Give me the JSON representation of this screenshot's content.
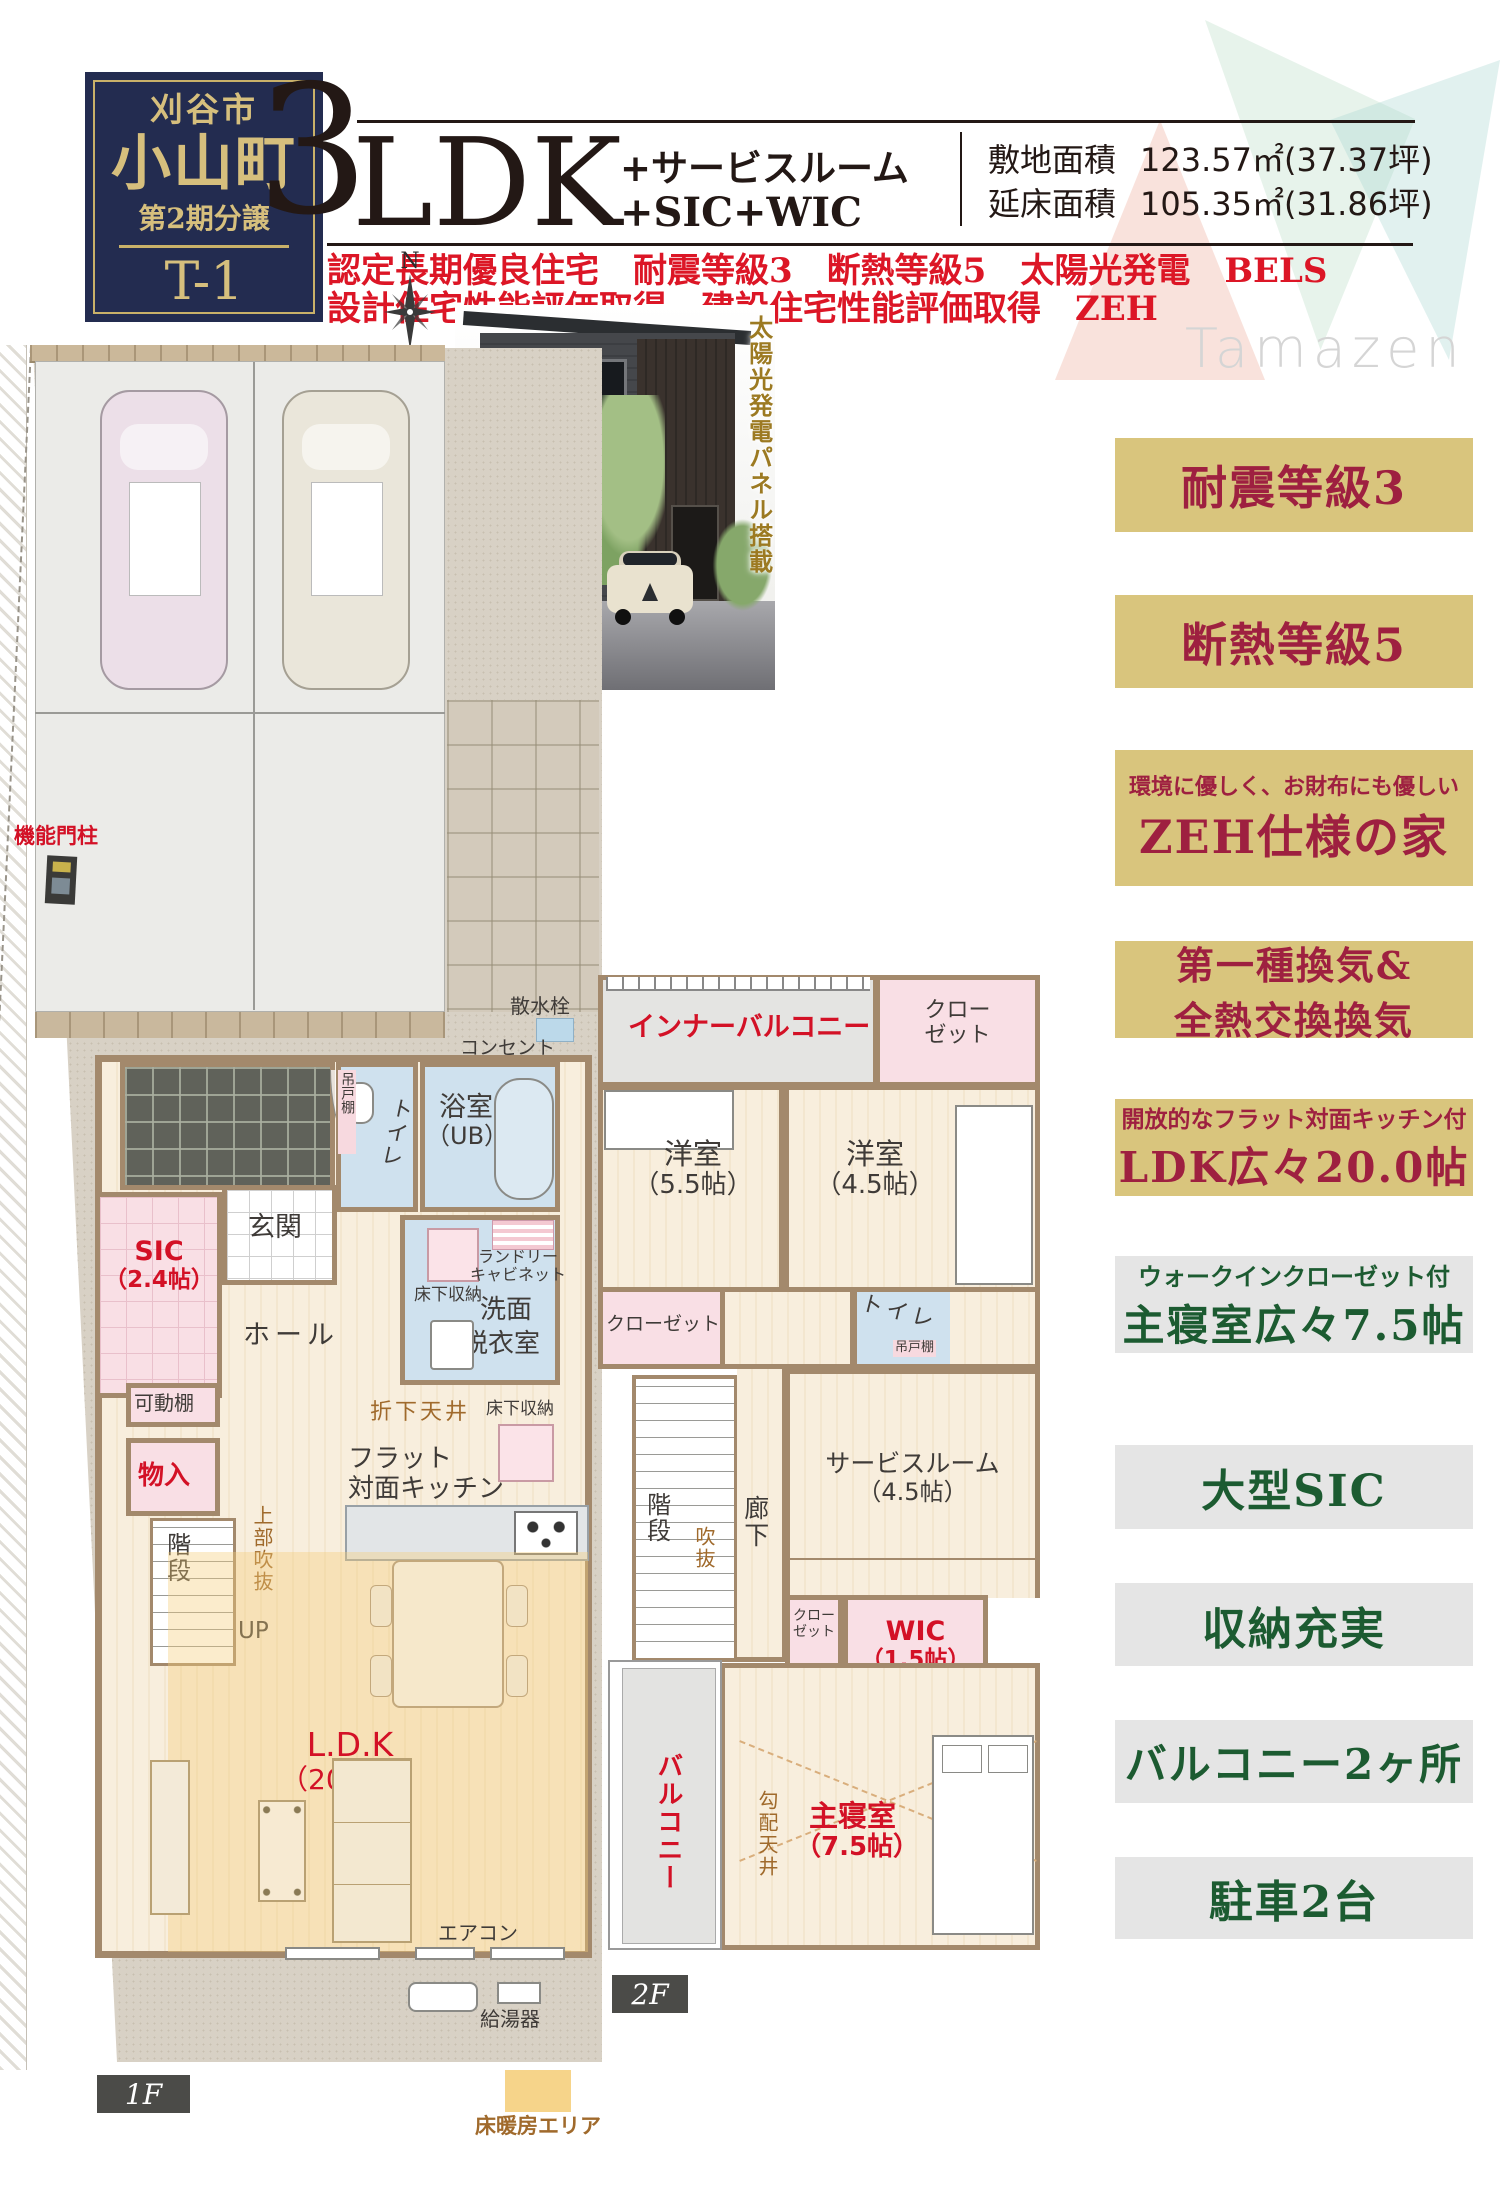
{
  "title_box": {
    "city": "刈谷市",
    "town": "小山町",
    "phase": "第2期分譲",
    "unit": "T-1"
  },
  "spec": {
    "num": "3",
    "type": "LDK",
    "plus1": "+サービスルーム",
    "plus2": "+SIC+WIC",
    "site_label": "敷地面積",
    "site_value": "123.57㎡(37.37坪)",
    "floor_label": "延床面積",
    "floor_value": "105.35㎡(31.86坪)",
    "features1": "認定長期優良住宅　耐震等級3　断熱等級5　太陽光発電　BELS",
    "features2": "設計住宅性能評価取得　建設住宅性能評価取得　ZEH"
  },
  "logo": "Tamazen",
  "corner_badge": "角地",
  "compass_n": "N",
  "photo_caption": "太陽光発電パネル搭載",
  "badges": [
    {
      "top": "",
      "line1": "耐震等級3",
      "line2": ""
    },
    {
      "top": "",
      "line1": "断熱等級5",
      "line2": ""
    },
    {
      "top": "環境に優しく、お財布にも優しい",
      "line1": "ZEH仕様の家",
      "line2": ""
    },
    {
      "top": "",
      "line1": "第一種換気&",
      "line2": "全熱交換換気"
    },
    {
      "top": "開放的なフラット対面キッチン付",
      "line1": "LDK広々20.0帖",
      "line2": ""
    },
    {
      "top": "ウォークインクローゼット付",
      "line1": "主寝室広々7.5帖",
      "line2": ""
    },
    {
      "top": "",
      "line1": "大型SIC",
      "line2": ""
    },
    {
      "top": "",
      "line1": "収納充実",
      "line2": ""
    },
    {
      "top": "",
      "line1": "バルコニー2ヶ所",
      "line2": ""
    },
    {
      "top": "",
      "line1": "駐車2台",
      "line2": ""
    }
  ],
  "plan1f": {
    "tag": "1F",
    "monchu": "機能門柱",
    "sansui": "散水栓",
    "outlet": "コンセント",
    "tsuridana": "吊戸棚",
    "toilet": "トイレ",
    "bath": "浴室",
    "bath_ub": "（UB）",
    "genkan": "玄関",
    "sic": "SIC",
    "sic_size": "（2.4帖）",
    "hall": "ホール",
    "laundry1": "ランドリー",
    "laundry2": "キャビネット",
    "underfloor": "床下収納",
    "senmen": "洗面",
    "datsui": "脱衣室",
    "kadodana": "可動棚",
    "monoire": "物入",
    "stairs": "階段",
    "up": "UP",
    "void_above": "上部吹抜",
    "orishita": "折下天井",
    "kitchen1": "フラット",
    "kitchen2": "対面キッチン",
    "ldk": "L.D.K",
    "ldk_size": "（20.0帖）",
    "aircon": "エアコン",
    "kyutoki": "給湯器"
  },
  "plan2f": {
    "tag": "2F",
    "inner_balcony": "インナーバルコニー",
    "closet_a": "クロー",
    "closet_b": "ゼット",
    "yoshitsu": "洋室",
    "size55": "（5.5帖）",
    "size45": "（4.5帖）",
    "closet": "クローゼット",
    "toilet": "トイレ",
    "tsuridana": "吊戸棚",
    "dn": "DN",
    "stairs": "階段",
    "void": "吹抜",
    "hallway": "廊下",
    "service": "サービスルーム",
    "wic": "WIC",
    "size15": "（1.5帖）",
    "balcony": "バルコニー",
    "slope": "勾配天井",
    "master": "主寝室",
    "size75": "（7.5帖）"
  },
  "legend": {
    "floor_heating": "床暖房エリア"
  },
  "colors": {
    "navy": "#232c50",
    "gold": "#d9c57d",
    "badge_red": "#9e2040",
    "badge_green": "#1c5b31",
    "maroon": "#7a1329",
    "label_red": "#d31126",
    "annotation_brown": "#a06a2c",
    "feature_red": "#dc1626",
    "wall": "#a3896c",
    "heating": "#f6d48a"
  }
}
